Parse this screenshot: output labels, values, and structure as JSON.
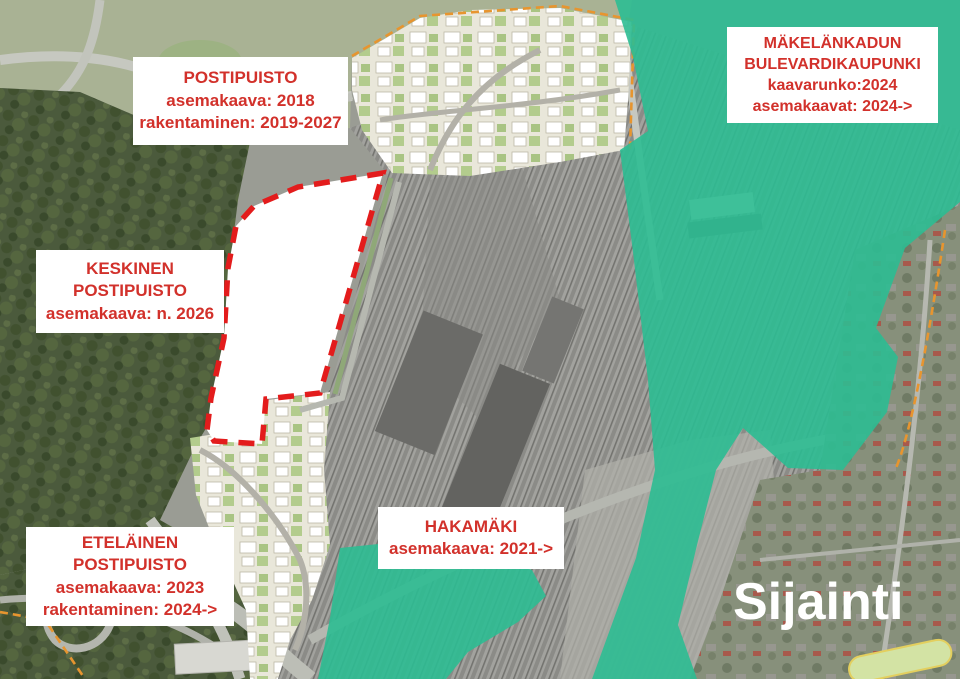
{
  "labels": {
    "postipuisto": {
      "lines": [
        "POSTIPUISTO",
        "asemakaava: 2018",
        "rakentaminen: 2019-2027"
      ]
    },
    "makelankatu": {
      "lines": [
        "MÄKELÄNKADUN",
        "BULEVARDIKAUPUNKI",
        "kaavarunko:2024",
        "asemakaavat: 2024->"
      ]
    },
    "keskinen": {
      "lines": [
        "KESKINEN",
        "POSTIPUISTO",
        "asemakaava: n. 2026"
      ]
    },
    "etelainen": {
      "lines": [
        "ETELÄINEN",
        "POSTIPUISTO",
        "asemakaava: 2023",
        "rakentaminen: 2024->"
      ]
    },
    "hakamaki": {
      "lines": [
        "HAKAMÄKI",
        "asemakaava: 2021->"
      ]
    }
  },
  "watermark": "Sijainti",
  "colors": {
    "label-red": "#d2312b",
    "dash-red": "#e31c1c",
    "overlay-teal": "#2cbd92",
    "boundary-orange": "#e7952f",
    "watermark-white": "#ffffff"
  }
}
